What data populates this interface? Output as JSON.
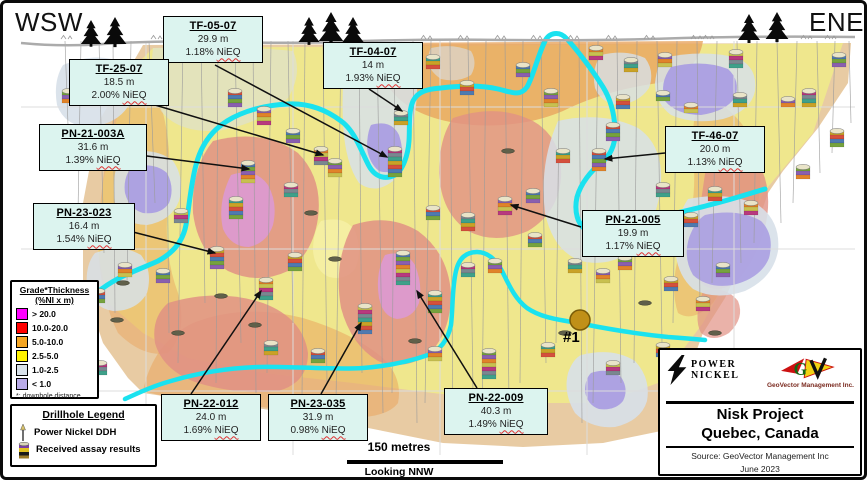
{
  "orientation": {
    "left": "WSW",
    "right": "ENE"
  },
  "callouts": [
    {
      "title": "TF-05-07",
      "depth": "29.9 m",
      "grade": "1.18%",
      "unit": "NiEQ"
    },
    {
      "title": "TF-25-07",
      "depth": "18.5 m",
      "grade": "2.00%",
      "unit": "NiEQ"
    },
    {
      "title": "TF-04-07",
      "depth": "14 m",
      "grade": "1.93%",
      "unit": "NiEQ"
    },
    {
      "title": "PN-21-003A",
      "depth": "31.6 m",
      "grade": "1.39%",
      "unit": "NiEQ"
    },
    {
      "title": "TF-46-07",
      "depth": "20.0 m",
      "grade": "1.13%",
      "unit": "NiEQ"
    },
    {
      "title": "PN-23-023",
      "depth": "16.4 m",
      "grade": "1.54%",
      "unit": "NiEQ"
    },
    {
      "title": "PN-21-005",
      "depth": "19.9 m",
      "grade": "1.17%",
      "unit": "NiEQ"
    },
    {
      "title": "PN-22-012",
      "depth": "24.0 m",
      "grade": "1.69%",
      "unit": "NiEQ"
    },
    {
      "title": "PN-23-035",
      "depth": "31.9 m",
      "grade": "0.98%",
      "unit": "NiEQ"
    },
    {
      "title": "PN-22-009",
      "depth": "40.3 m",
      "grade": "1.49%",
      "unit": "NiEQ"
    }
  ],
  "pit_label": "#1",
  "grade_legend": {
    "title": "Grade*Thickness",
    "subtitle": "(%NI x m)",
    "items": [
      {
        "label": "> 20.0",
        "color": "#ff00ff"
      },
      {
        "label": "10.0-20.0",
        "color": "#ff0000"
      },
      {
        "label": "5.0-10.0",
        "color": "#f5a623"
      },
      {
        "label": "2.5-5.0",
        "color": "#fff200"
      },
      {
        "label": "1.0-2.5",
        "color": "#d9e2ea"
      },
      {
        "label": "< 1.0",
        "color": "#b9abe8"
      }
    ],
    "footnote": "*: downhole distance"
  },
  "drillhole_legend": {
    "title": "Drillhole Legend",
    "items": [
      "Power Nickel DDH",
      "Received assay results"
    ]
  },
  "scale": {
    "distance": "150 metres",
    "view": "Looking NNW"
  },
  "title_block": {
    "company_line1": "POWER",
    "company_line2": "NICKEL",
    "consultant": "GeoVector Management Inc.",
    "project": "Nisk Project",
    "location": "Quebec, Canada",
    "source": "Source: GeoVector Management Inc",
    "date": "June 2023"
  },
  "map": {
    "colors": {
      "contour": "#1ae2ef",
      "surface": "#ababab",
      "tan": "#e7c89e",
      "yellow": "#efe88c",
      "orange": "#e9a55f",
      "red": "#e19184",
      "magenta": "#dc99d3",
      "grayblue": "#d7e0e9",
      "purple": "#a79be2"
    },
    "grid": {
      "v": [
        143,
        290,
        437,
        584,
        731
      ],
      "h": [
        104,
        246,
        388
      ]
    },
    "palette": [
      "#c9a227",
      "#d4503c",
      "#4f7ab0",
      "#76a23e",
      "#8a5fae",
      "#e0832a",
      "#c8c050",
      "#b8397e",
      "#7a8790",
      "#3fa08a"
    ],
    "holes": [
      [
        62,
        4,
        150
      ],
      [
        78,
        -3,
        210
      ],
      [
        96,
        5,
        250
      ],
      [
        110,
        2,
        310
      ],
      [
        128,
        -4,
        280
      ],
      [
        146,
        6,
        200
      ],
      [
        163,
        3,
        330
      ],
      [
        180,
        -5,
        360
      ],
      [
        198,
        4,
        300
      ],
      [
        215,
        -2,
        380
      ],
      [
        232,
        6,
        340
      ],
      [
        250,
        3,
        390
      ],
      [
        268,
        -4,
        370
      ],
      [
        285,
        5,
        320
      ],
      [
        302,
        -3,
        395
      ],
      [
        320,
        4,
        380
      ],
      [
        338,
        -5,
        400
      ],
      [
        356,
        3,
        370
      ],
      [
        374,
        6,
        410
      ],
      [
        392,
        -3,
        390
      ],
      [
        410,
        4,
        420
      ],
      [
        428,
        -6,
        400
      ],
      [
        447,
        3,
        430
      ],
      [
        465,
        5,
        390
      ],
      [
        483,
        -4,
        420
      ],
      [
        502,
        4,
        400
      ],
      [
        520,
        -3,
        380
      ],
      [
        538,
        5,
        360
      ],
      [
        557,
        -4,
        340
      ],
      [
        576,
        3,
        420
      ],
      [
        595,
        -5,
        400
      ],
      [
        614,
        4,
        380
      ],
      [
        634,
        -3,
        360
      ],
      [
        654,
        5,
        340
      ],
      [
        674,
        -4,
        320
      ],
      [
        694,
        3,
        300
      ],
      [
        714,
        -5,
        280
      ],
      [
        734,
        4,
        260
      ],
      [
        754,
        -3,
        240
      ],
      [
        774,
        4,
        220
      ],
      [
        794,
        -4,
        200
      ],
      [
        814,
        3,
        170
      ],
      [
        832,
        -3,
        150
      ],
      [
        846,
        2,
        120
      ]
    ],
    "markers": [
      [
        107,
        64,
        18,
        0
      ],
      [
        66,
        88,
        12,
        3
      ],
      [
        232,
        88,
        16,
        1
      ],
      [
        261,
        106,
        16,
        4
      ],
      [
        290,
        128,
        10,
        2
      ],
      [
        318,
        146,
        16,
        5
      ],
      [
        348,
        64,
        10,
        6
      ],
      [
        392,
        146,
        26,
        7
      ],
      [
        398,
        110,
        10,
        8
      ],
      [
        430,
        54,
        12,
        9
      ],
      [
        464,
        80,
        12,
        0
      ],
      [
        520,
        62,
        12,
        2
      ],
      [
        548,
        88,
        14,
        3
      ],
      [
        610,
        122,
        16,
        1
      ],
      [
        593,
        45,
        12,
        5
      ],
      [
        628,
        57,
        12,
        8
      ],
      [
        662,
        52,
        10,
        4
      ],
      [
        733,
        49,
        14,
        6
      ],
      [
        836,
        52,
        12,
        2
      ],
      [
        806,
        88,
        14,
        7
      ],
      [
        834,
        128,
        14,
        0
      ],
      [
        800,
        164,
        12,
        3
      ],
      [
        560,
        148,
        10,
        9
      ],
      [
        596,
        148,
        18,
        1
      ],
      [
        620,
        94,
        10,
        0
      ],
      [
        660,
        90,
        8,
        2
      ],
      [
        688,
        102,
        8,
        5
      ],
      [
        737,
        92,
        10,
        8
      ],
      [
        785,
        96,
        8,
        4
      ],
      [
        178,
        208,
        12,
        6
      ],
      [
        245,
        160,
        18,
        2
      ],
      [
        233,
        196,
        20,
        9
      ],
      [
        214,
        246,
        18,
        0
      ],
      [
        288,
        182,
        12,
        7
      ],
      [
        332,
        158,
        14,
        3
      ],
      [
        430,
        205,
        12,
        1
      ],
      [
        465,
        212,
        14,
        8
      ],
      [
        502,
        196,
        16,
        4
      ],
      [
        530,
        188,
        12,
        2
      ],
      [
        628,
        212,
        12,
        6
      ],
      [
        688,
        212,
        12,
        0
      ],
      [
        712,
        186,
        12,
        9
      ],
      [
        748,
        200,
        12,
        5
      ],
      [
        660,
        182,
        10,
        7
      ],
      [
        622,
        255,
        12,
        3
      ],
      [
        572,
        258,
        12,
        8
      ],
      [
        95,
        288,
        12,
        1
      ],
      [
        122,
        262,
        10,
        4
      ],
      [
        160,
        268,
        10,
        2
      ],
      [
        263,
        277,
        18,
        5
      ],
      [
        292,
        252,
        14,
        0
      ],
      [
        362,
        303,
        26,
        6
      ],
      [
        400,
        250,
        30,
        2
      ],
      [
        432,
        290,
        18,
        9
      ],
      [
        465,
        262,
        12,
        7
      ],
      [
        492,
        258,
        12,
        3
      ],
      [
        532,
        232,
        12,
        1
      ],
      [
        600,
        268,
        10,
        4
      ],
      [
        668,
        276,
        12,
        0
      ],
      [
        700,
        296,
        12,
        5
      ],
      [
        720,
        262,
        10,
        2
      ],
      [
        268,
        340,
        12,
        8
      ],
      [
        315,
        348,
        10,
        1
      ],
      [
        432,
        346,
        12,
        4
      ],
      [
        486,
        348,
        26,
        3
      ],
      [
        545,
        342,
        10,
        9
      ],
      [
        610,
        360,
        12,
        6
      ],
      [
        97,
        360,
        10,
        7
      ],
      [
        660,
        342,
        10,
        0
      ]
    ],
    "discs": [
      [
        120,
        280
      ],
      [
        114,
        317
      ],
      [
        218,
        293
      ],
      [
        252,
        322
      ],
      [
        332,
        256
      ],
      [
        412,
        338
      ],
      [
        562,
        330
      ],
      [
        642,
        300
      ],
      [
        712,
        330
      ],
      [
        80,
        345
      ],
      [
        175,
        330
      ],
      [
        505,
        148
      ],
      [
        308,
        210
      ]
    ],
    "trees": [
      [
        88,
        41,
        24
      ],
      [
        112,
        41,
        27
      ],
      [
        306,
        39,
        25
      ],
      [
        328,
        38,
        29
      ],
      [
        350,
        39,
        25
      ],
      [
        746,
        37,
        26
      ],
      [
        774,
        36,
        27
      ]
    ],
    "surface_marks": [
      58,
      148,
      200,
      243,
      418,
      455,
      492,
      528,
      565,
      603,
      641,
      688,
      700,
      798,
      822
    ],
    "arrows": [
      [
        212,
        62,
        384,
        154
      ],
      [
        152,
        102,
        320,
        152
      ],
      [
        366,
        86,
        399,
        108
      ],
      [
        136,
        152,
        246,
        166
      ],
      [
        662,
        150,
        602,
        156
      ],
      [
        126,
        228,
        212,
        250
      ],
      [
        578,
        224,
        508,
        202
      ],
      [
        188,
        391,
        258,
        288
      ],
      [
        318,
        391,
        358,
        320
      ],
      [
        474,
        385,
        414,
        288
      ]
    ]
  }
}
